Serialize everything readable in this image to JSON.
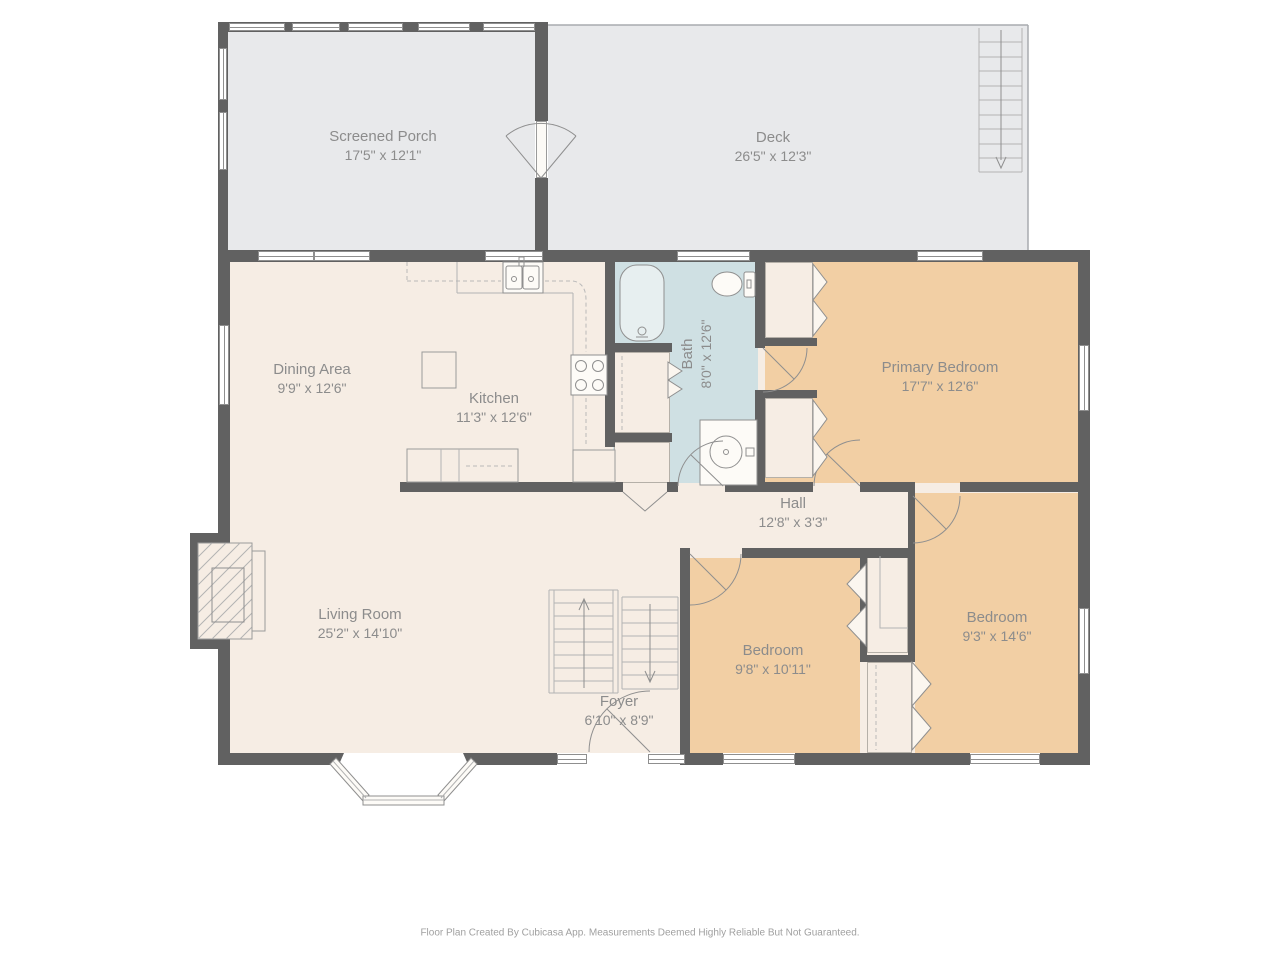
{
  "colors": {
    "wall": "#616161",
    "floor": "#f6ede4",
    "outdoor": "#e8e9eb",
    "bedroom": "#f2cfa4",
    "bathroom": "#cfe0e3",
    "window": "#ffffff",
    "line": "#8f8f8f",
    "label": "#8c8c8c"
  },
  "rooms": {
    "screened_porch": {
      "name": "Screened Porch",
      "dims": "17'5\" x 12'1\""
    },
    "deck": {
      "name": "Deck",
      "dims": "26'5\" x 12'3\""
    },
    "dining": {
      "name": "Dining Area",
      "dims": "9'9\" x 12'6\""
    },
    "kitchen": {
      "name": "Kitchen",
      "dims": "11'3\" x 12'6\""
    },
    "bath": {
      "name": "Bath",
      "dims": "8'0\" x 12'6\""
    },
    "primary_bedroom": {
      "name": "Primary Bedroom",
      "dims": "17'7\" x 12'6\""
    },
    "hall": {
      "name": "Hall",
      "dims": "12'8\" x 3'3\""
    },
    "living_room": {
      "name": "Living Room",
      "dims": "25'2\" x 14'10\""
    },
    "bedroom_mid": {
      "name": "Bedroom",
      "dims": "9'8\" x 10'11\""
    },
    "bedroom_right": {
      "name": "Bedroom",
      "dims": "9'3\" x 14'6\""
    },
    "foyer": {
      "name": "Foyer",
      "dims": "6'10\" x 8'9\""
    }
  },
  "footer": "Floor Plan Created By Cubicasa App. Measurements Deemed Highly Reliable But Not Guaranteed."
}
